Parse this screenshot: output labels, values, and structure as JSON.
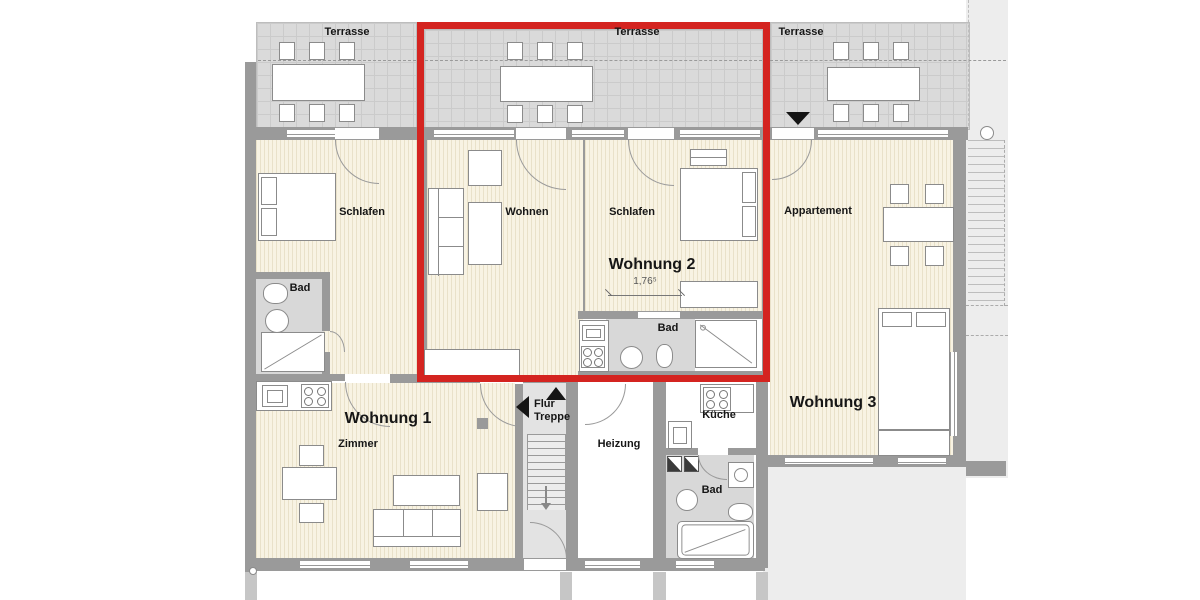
{
  "labels": {
    "terrasse_1": "Terrasse",
    "terrasse_2": "Terrasse",
    "terrasse_3": "Terrasse",
    "schlafen_w1": "Schlafen",
    "wohnen_w2": "Wohnen",
    "schlafen_w2": "Schlafen",
    "appartement": "Appartement",
    "bad_w1": "Bad",
    "bad_w2": "Bad",
    "bad_w3": "Bad",
    "wohnung_1": "Wohnung 1",
    "wohnung_2": "Wohnung 2",
    "wohnung_3": "Wohnung 3",
    "zimmer_w1": "Zimmer",
    "flur_line1": "Flur",
    "flur_line2": "Treppe",
    "heizung": "Heizung",
    "kueche": "Küche"
  },
  "dimensions": {
    "schlafen_w2_width": "1,76⁵"
  },
  "highlight": {
    "outlined_unit": "Wohnung 2",
    "color": "#d42420"
  },
  "colors": {
    "wall": "#9a9a9a",
    "terrace": "#dadada",
    "floor": "#f8f3e3",
    "wet_room": "#d8d8d8",
    "corridor": "#e3e3e3",
    "outline_red": "#d42420"
  }
}
